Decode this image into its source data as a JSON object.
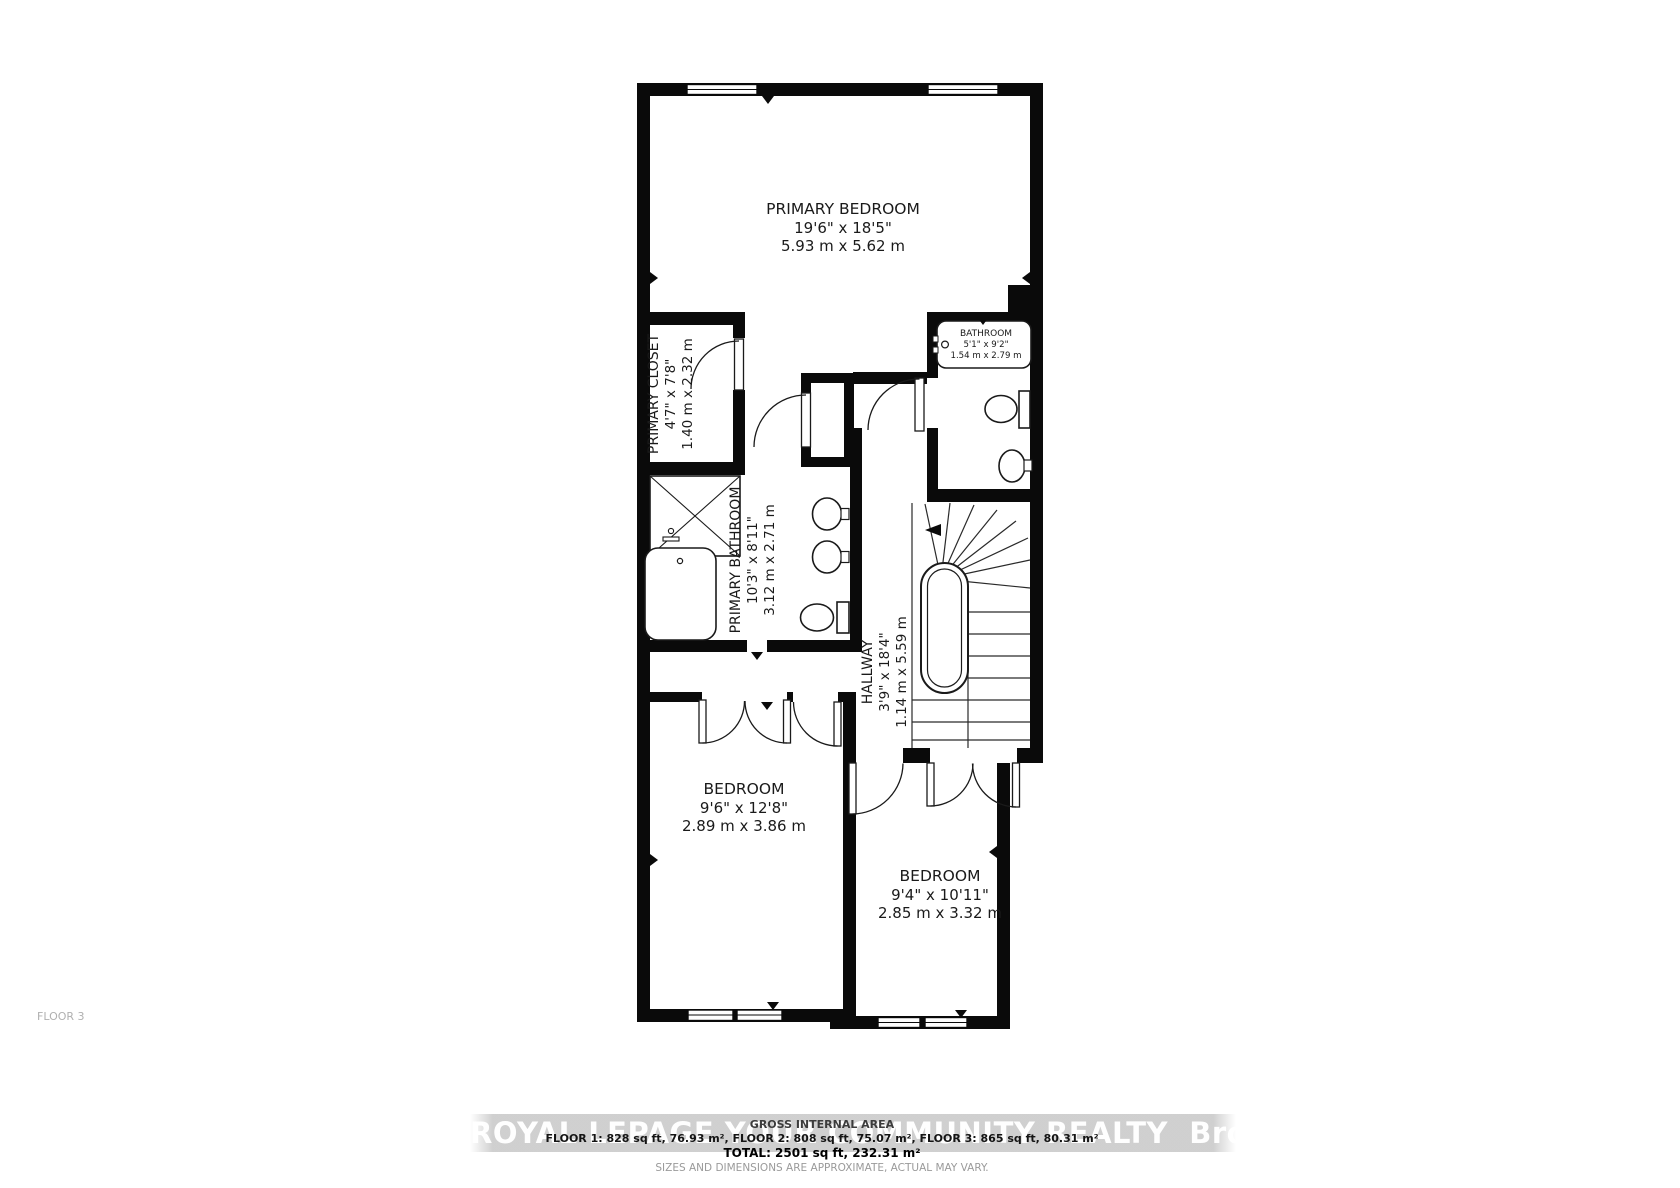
{
  "floor_plan": {
    "floor_label": "FLOOR 3",
    "rooms": {
      "primary_bedroom": {
        "name": "PRIMARY BEDROOM",
        "imperial": "19'6\" x 18'5\"",
        "metric": "5.93 m x 5.62 m"
      },
      "primary_closet": {
        "name": "PRIMARY CLOSET",
        "imperial": "4'7\" x 7'8\"",
        "metric": "1.40 m x 2.32 m"
      },
      "bathroom": {
        "name": "BATHROOM",
        "imperial": "5'1\" x 9'2\"",
        "metric": "1.54 m x 2.79 m"
      },
      "primary_bathroom": {
        "name": "PRIMARY BATHROOM",
        "imperial": "10'3\" x 8'11\"",
        "metric": "3.12 m x 2.71 m"
      },
      "hallway": {
        "name": "HALLWAY",
        "imperial": "3'9\" x 18'4\"",
        "metric": "1.14 m x 5.59 m"
      },
      "bedroom_left": {
        "name": "BEDROOM",
        "imperial": "9'6\" x 12'8\"",
        "metric": "2.89 m x 3.86 m"
      },
      "bedroom_right": {
        "name": "BEDROOM",
        "imperial": "9'4\" x 10'11\"",
        "metric": "2.85 m x 3.32 m"
      }
    }
  },
  "footer": {
    "heading": "GROSS INTERNAL AREA",
    "floor_areas": "FLOOR 1: 828 sq ft, 76.93 m², FLOOR 2: 808 sq ft, 75.07 m², FLOOR 3: 865 sq ft, 80.31 m²",
    "total": "TOTAL: 2501 sq ft, 232.31 m²",
    "disclaimer": "SIZES AND DIMENSIONS ARE APPROXIMATE, ACTUAL MAY VARY."
  },
  "watermark": {
    "brand": "ROYAL LEPAGE YOUR COMMUNITY REALTY",
    "suffix": "Brokerage"
  }
}
